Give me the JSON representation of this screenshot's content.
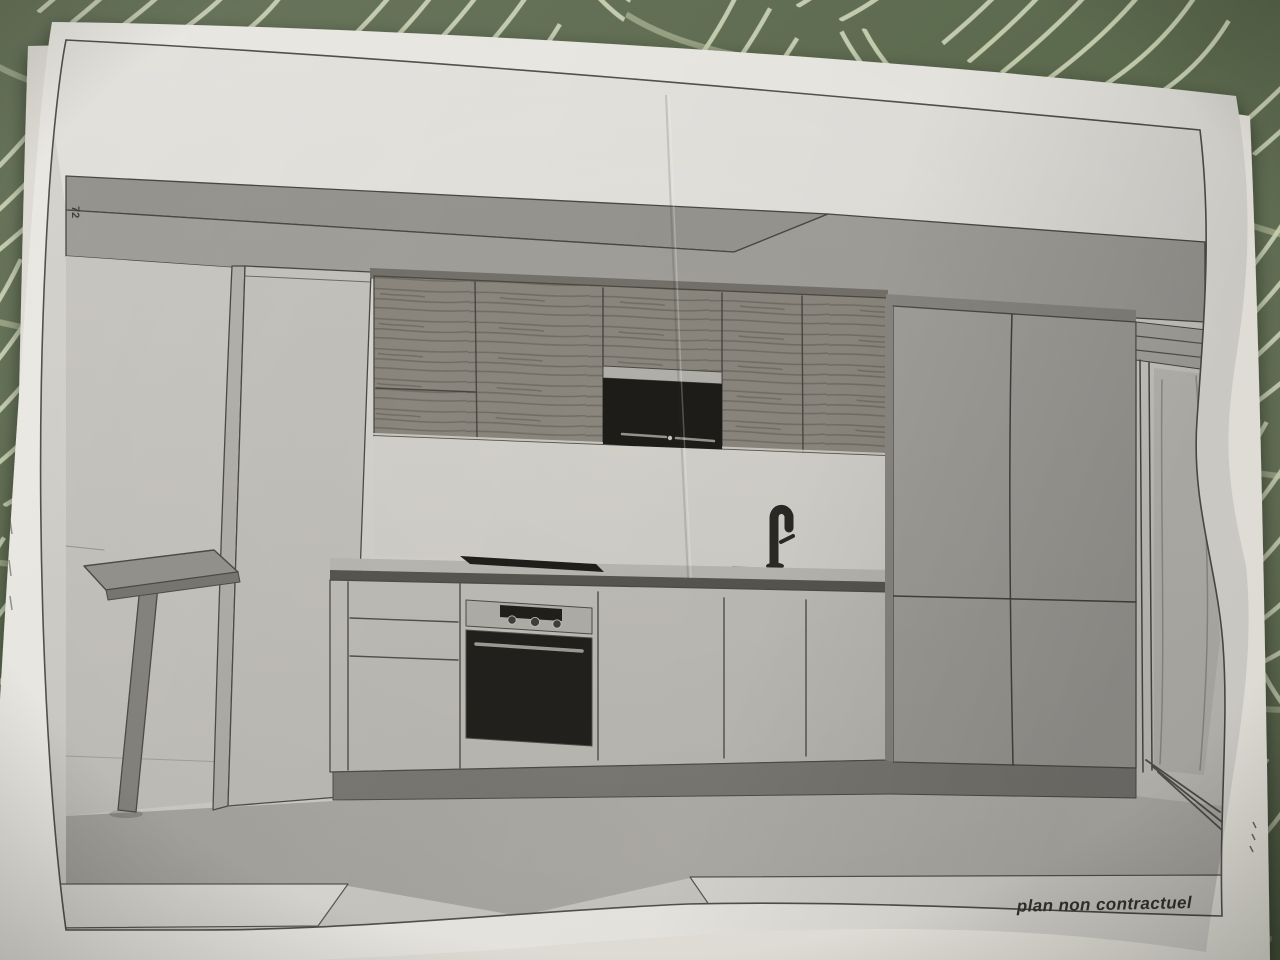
{
  "caption": {
    "text": "plan non contractuel"
  },
  "margin_notes": {
    "left_vertical": "72"
  },
  "scene": {
    "objects": [
      "ceiling soffit",
      "breakfast bar",
      "tall cabinet column",
      "wood wall cabinets",
      "built-in microwave",
      "backsplash",
      "countertop",
      "cooktop",
      "sink with mixer tap",
      "drawer unit",
      "built-in oven",
      "base cabinets",
      "tall cabinets right",
      "doorway opening",
      "floor"
    ]
  },
  "colors": {
    "tablecloth_green": "#5d6b4e",
    "tablecloth_vein": "#d9dfc0",
    "paper": "#f1efe9",
    "back_sheet": "#e4e2da",
    "frame_line": "#55534e",
    "wall": "#dedcd6",
    "ceiling": "#eceae5",
    "soffit": "#a6a49e",
    "soffit_wedge": "#9b9993",
    "left_wall": "#d0cec8",
    "column": "#cbc9c3",
    "wood_cabinet": "#8e8a81",
    "backsplash": "#dcdad4",
    "counter_surface": "#c2c0ba",
    "counter_edge": "#55534e",
    "appliance_black": "#171613",
    "stainless": "#b9b7b1",
    "base_cabinet": "#c8c6c0",
    "plinth": "#7d7b76",
    "tall_unit_right": "#a8a6a1",
    "doorway": "#cfcdc7",
    "bar_top": "#9a9892",
    "caption_text": "#3b3936"
  }
}
